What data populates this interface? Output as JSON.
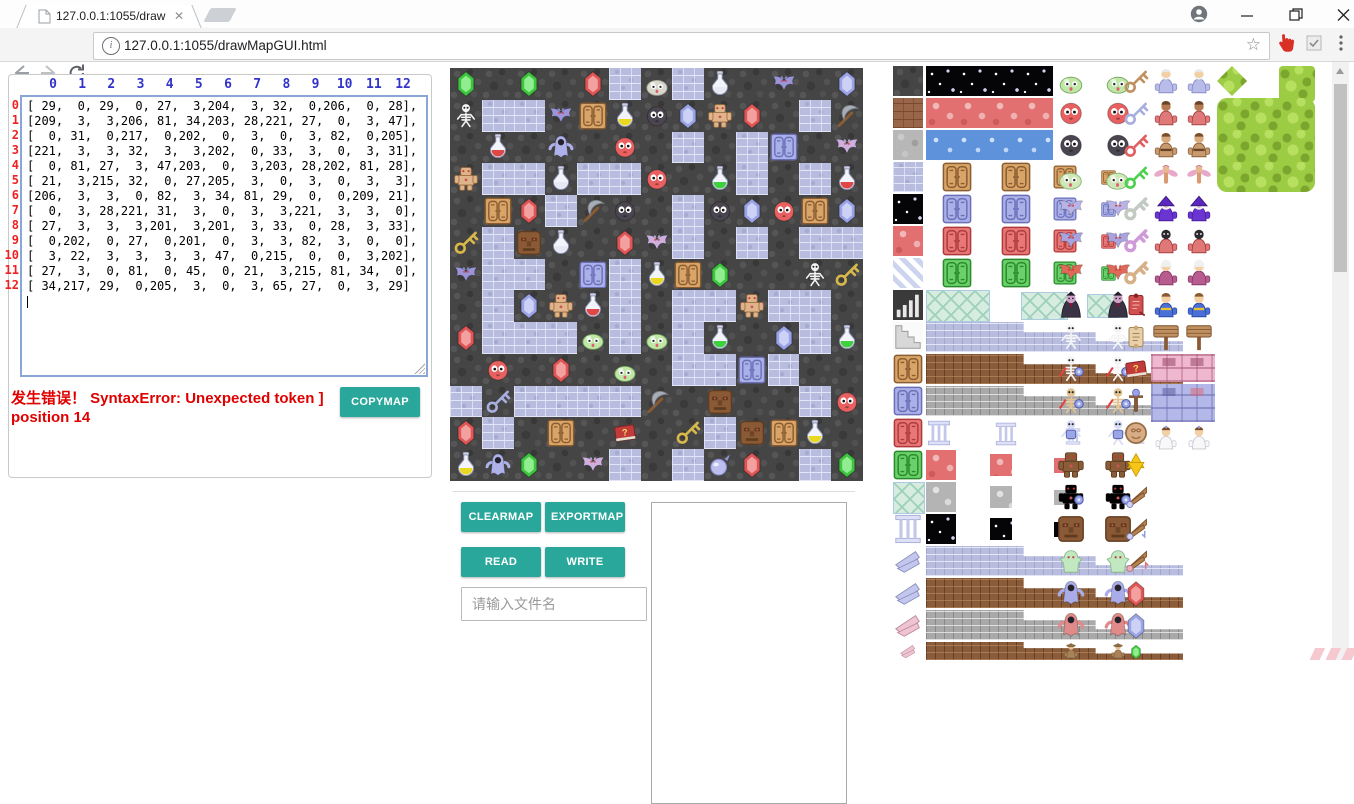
{
  "browser": {
    "tab_title": "127.0.0.1:1055/drawMa",
    "url": "127.0.0.1:1055/drawMapGUI.html",
    "info_glyph": "i"
  },
  "matrix": {
    "col_headers": [
      0,
      1,
      2,
      3,
      4,
      5,
      6,
      7,
      8,
      9,
      10,
      11,
      12
    ],
    "row_headers": [
      0,
      1,
      2,
      3,
      4,
      5,
      6,
      7,
      8,
      9,
      10,
      11,
      12
    ],
    "rows": [
      [
        29,
        0,
        29,
        0,
        27,
        3,
        204,
        3,
        32,
        0,
        206,
        0,
        28
      ],
      [
        209,
        3,
        3,
        206,
        81,
        34,
        203,
        28,
        221,
        27,
        0,
        3,
        47
      ],
      [
        0,
        31,
        0,
        217,
        0,
        202,
        0,
        3,
        0,
        3,
        82,
        0,
        205
      ],
      [
        221,
        3,
        3,
        32,
        3,
        3,
        202,
        0,
        33,
        3,
        0,
        3,
        31
      ],
      [
        0,
        81,
        27,
        3,
        47,
        203,
        0,
        3,
        203,
        28,
        202,
        81,
        28
      ],
      [
        21,
        3,
        215,
        32,
        0,
        27,
        205,
        3,
        0,
        3,
        0,
        3,
        3
      ],
      [
        206,
        3,
        3,
        0,
        82,
        3,
        34,
        81,
        29,
        0,
        0,
        209,
        21
      ],
      [
        0,
        3,
        28,
        221,
        31,
        3,
        0,
        3,
        3,
        221,
        3,
        3,
        0
      ],
      [
        27,
        3,
        3,
        3,
        201,
        3,
        201,
        3,
        33,
        0,
        28,
        3,
        33
      ],
      [
        0,
        202,
        0,
        27,
        0,
        201,
        0,
        3,
        3,
        82,
        3,
        0,
        0
      ],
      [
        3,
        22,
        3,
        3,
        3,
        3,
        47,
        0,
        215,
        0,
        0,
        3,
        202
      ],
      [
        27,
        3,
        0,
        81,
        0,
        45,
        0,
        21,
        3,
        215,
        81,
        34,
        0
      ],
      [
        34,
        217,
        29,
        0,
        205,
        3,
        0,
        3,
        65,
        27,
        0,
        3,
        29
      ]
    ]
  },
  "error": {
    "line1": "发生错误！ SyntaxError: Unexpected token ]",
    "line2": "position 14"
  },
  "buttons": {
    "copymap": "COPYMAP",
    "clearmap": "CLEARMAP",
    "exportmap": "EXPORTMAP",
    "read": "READ",
    "write": "WRITE"
  },
  "file_input": {
    "placeholder": "请输入文件名",
    "value": ""
  },
  "colors": {
    "accent_teal": "#2aa79b",
    "error_red": "#e00000",
    "col_header_blue": "#3333cc",
    "row_header_red": "#ee2222"
  },
  "tile_legend": {
    "0": "cobble_dark",
    "3": "brick_lav",
    "21": "key_yellow",
    "22": "key_blue",
    "27": "gem_red",
    "28": "gem_blue",
    "29": "gem_green",
    "31": "potion_red",
    "32": "potion_silver",
    "33": "potion_green",
    "34": "potion_yellow",
    "45": "book",
    "47": "pickaxe",
    "65": "orb",
    "81": "door_tan",
    "82": "door_lav",
    "201": "slime_green",
    "202": "ball_red",
    "203": "ball_dark",
    "204": "slime_gray",
    "205": "bat_pink",
    "206": "bat_purple",
    "209": "skeleton",
    "215": "tiki",
    "217": "ghost",
    "221": "golem"
  },
  "tileset": {
    "cells": [
      [
        0,
        0,
        30,
        30,
        "cobble_dark"
      ],
      [
        0,
        32,
        30,
        30,
        "brick_brown"
      ],
      [
        0,
        64,
        30,
        30,
        "cobble_gray"
      ],
      [
        0,
        96,
        30,
        30,
        "brick_lav"
      ],
      [
        0,
        128,
        30,
        30,
        "night"
      ],
      [
        0,
        160,
        30,
        30,
        "floor_red"
      ],
      [
        0,
        192,
        30,
        30,
        "stripes"
      ],
      [
        0,
        224,
        30,
        30,
        "stairs_dark"
      ],
      [
        0,
        256,
        30,
        30,
        "steps_gray"
      ],
      [
        0,
        288,
        30,
        30,
        "door_tan"
      ],
      [
        0,
        320,
        30,
        30,
        "door_lav"
      ],
      [
        0,
        352,
        30,
        30,
        "door_red"
      ],
      [
        0,
        384,
        30,
        30,
        "door_green"
      ],
      [
        0,
        416,
        30,
        30,
        "ice"
      ],
      [
        0,
        448,
        30,
        30,
        "pillar"
      ],
      [
        0,
        480,
        30,
        30,
        "wing_lav"
      ],
      [
        0,
        512,
        30,
        30,
        "wing_lav"
      ],
      [
        0,
        544,
        30,
        30,
        "wing_pink"
      ],
      [
        0,
        576,
        30,
        18,
        "wing_pink"
      ],
      [
        33,
        0,
        127,
        30,
        "night"
      ],
      [
        33,
        32,
        127,
        30,
        "floor_red"
      ],
      [
        33,
        64,
        127,
        30,
        "water"
      ],
      [
        33,
        96,
        62,
        30,
        "door_tan"
      ],
      [
        108,
        96,
        30,
        30,
        "door_tan"
      ],
      [
        160,
        99,
        24,
        24,
        "door_tan"
      ],
      [
        208,
        104,
        15,
        15,
        "door_tan"
      ],
      [
        33,
        128,
        62,
        30,
        "door_lav"
      ],
      [
        108,
        128,
        30,
        30,
        "door_lav"
      ],
      [
        160,
        131,
        24,
        24,
        "door_lav"
      ],
      [
        208,
        136,
        15,
        15,
        "door_lav"
      ],
      [
        33,
        160,
        62,
        30,
        "door_red"
      ],
      [
        108,
        160,
        30,
        30,
        "door_red"
      ],
      [
        160,
        163,
        24,
        24,
        "door_red"
      ],
      [
        208,
        168,
        15,
        15,
        "door_red"
      ],
      [
        33,
        192,
        62,
        30,
        "door_green"
      ],
      [
        108,
        192,
        30,
        30,
        "door_green"
      ],
      [
        160,
        195,
        24,
        24,
        "door_green"
      ],
      [
        208,
        200,
        15,
        15,
        "door_green"
      ],
      [
        33,
        224,
        62,
        30,
        "ice"
      ],
      [
        128,
        226,
        45,
        26,
        "ice"
      ],
      [
        194,
        228,
        30,
        22,
        "ice"
      ],
      [
        33,
        256,
        257,
        30,
        "ledge_lav"
      ],
      [
        33,
        288,
        257,
        30,
        "ledge_brown"
      ],
      [
        33,
        320,
        257,
        30,
        "ledge_gray"
      ],
      [
        33,
        352,
        26,
        30,
        "pillar"
      ],
      [
        95,
        356,
        36,
        24,
        "pillar"
      ],
      [
        157,
        362,
        46,
        17,
        "pillar"
      ],
      [
        219,
        368,
        56,
        10,
        "pillar"
      ],
      [
        33,
        384,
        30,
        30,
        "floor_red"
      ],
      [
        97,
        388,
        22,
        22,
        "floor_red"
      ],
      [
        161,
        392,
        15,
        15,
        "floor_red"
      ],
      [
        225,
        396,
        7,
        7,
        "floor_red"
      ],
      [
        33,
        416,
        30,
        30,
        "floor_gray2"
      ],
      [
        97,
        420,
        22,
        22,
        "floor_gray2"
      ],
      [
        161,
        424,
        15,
        15,
        "floor_gray2"
      ],
      [
        225,
        428,
        7,
        7,
        "floor_gray2"
      ],
      [
        33,
        448,
        30,
        30,
        "night"
      ],
      [
        97,
        452,
        22,
        22,
        "night"
      ],
      [
        161,
        456,
        15,
        15,
        "night"
      ],
      [
        225,
        460,
        7,
        7,
        "night"
      ],
      [
        33,
        480,
        257,
        30,
        "ledge_lav"
      ],
      [
        33,
        512,
        257,
        30,
        "ledge_brown"
      ],
      [
        33,
        544,
        257,
        30,
        "ledge_gray"
      ],
      [
        33,
        576,
        257,
        18,
        "ledge_brown"
      ],
      [
        163,
        0,
        30,
        30,
        "slime_green"
      ],
      [
        210,
        0,
        30,
        30,
        "slime_green"
      ],
      [
        163,
        32,
        30,
        30,
        "ball_red"
      ],
      [
        210,
        32,
        30,
        30,
        "ball_red"
      ],
      [
        163,
        64,
        30,
        30,
        "ball_dark"
      ],
      [
        210,
        64,
        30,
        30,
        "ball_dark"
      ],
      [
        161,
        96,
        33,
        30,
        "slime_big"
      ],
      [
        208,
        96,
        33,
        30,
        "slime_big"
      ],
      [
        163,
        128,
        30,
        30,
        "bat_sm"
      ],
      [
        210,
        128,
        30,
        30,
        "bat_sm"
      ],
      [
        163,
        160,
        30,
        30,
        "bat_big"
      ],
      [
        210,
        160,
        30,
        30,
        "bat_big"
      ],
      [
        163,
        192,
        30,
        30,
        "bat_red"
      ],
      [
        210,
        192,
        30,
        30,
        "bat_red"
      ],
      [
        163,
        224,
        30,
        30,
        "vampire"
      ],
      [
        210,
        224,
        30,
        30,
        "vampire"
      ],
      [
        163,
        256,
        30,
        30,
        "skeleton"
      ],
      [
        210,
        256,
        30,
        30,
        "skeleton"
      ],
      [
        163,
        288,
        30,
        30,
        "skel_arm"
      ],
      [
        210,
        288,
        30,
        30,
        "skel_arm"
      ],
      [
        163,
        320,
        30,
        30,
        "skel_tan"
      ],
      [
        210,
        320,
        30,
        30,
        "skel_tan"
      ],
      [
        163,
        352,
        30,
        30,
        "skel_blue"
      ],
      [
        210,
        352,
        30,
        30,
        "skel_blue"
      ],
      [
        163,
        384,
        30,
        30,
        "ape"
      ],
      [
        210,
        384,
        30,
        30,
        "ape"
      ],
      [
        163,
        416,
        30,
        30,
        "ape_shield"
      ],
      [
        210,
        416,
        30,
        30,
        "ape_shield"
      ],
      [
        163,
        448,
        30,
        30,
        "tiki"
      ],
      [
        210,
        448,
        30,
        30,
        "tiki"
      ],
      [
        163,
        480,
        30,
        30,
        "slimeman"
      ],
      [
        210,
        480,
        30,
        30,
        "slimeman"
      ],
      [
        163,
        512,
        30,
        30,
        "ghost_blue"
      ],
      [
        210,
        512,
        30,
        30,
        "ghost_blue"
      ],
      [
        163,
        544,
        30,
        30,
        "ghost_red"
      ],
      [
        210,
        544,
        30,
        30,
        "ghost_red"
      ],
      [
        163,
        576,
        30,
        18,
        "hatman"
      ],
      [
        210,
        576,
        30,
        18,
        "hatman"
      ],
      [
        229,
        2,
        28,
        28,
        "key_tan"
      ],
      [
        229,
        34,
        28,
        28,
        "key_blue"
      ],
      [
        229,
        66,
        28,
        28,
        "key_red"
      ],
      [
        229,
        98,
        28,
        28,
        "key_green"
      ],
      [
        229,
        128,
        28,
        30,
        "key_big_gray"
      ],
      [
        229,
        160,
        28,
        30,
        "key_big_purple"
      ],
      [
        229,
        192,
        28,
        30,
        "key_big_tan"
      ],
      [
        229,
        224,
        28,
        30,
        "scroll_red"
      ],
      [
        229,
        256,
        28,
        30,
        "scroll_tan"
      ],
      [
        229,
        288,
        28,
        30,
        "book"
      ],
      [
        229,
        320,
        28,
        30,
        "staff"
      ],
      [
        229,
        352,
        28,
        30,
        "coin"
      ],
      [
        229,
        384,
        28,
        30,
        "star"
      ],
      [
        229,
        416,
        28,
        30,
        "wing1"
      ],
      [
        229,
        448,
        28,
        30,
        "wing2"
      ],
      [
        229,
        480,
        28,
        30,
        "wing3"
      ],
      [
        229,
        514,
        28,
        28,
        "gem_red"
      ],
      [
        229,
        546,
        28,
        28,
        "gem_blue"
      ],
      [
        229,
        578,
        28,
        16,
        "gem_green"
      ],
      [
        258,
        0,
        30,
        30,
        "oldman"
      ],
      [
        291,
        0,
        30,
        30,
        "oldman"
      ],
      [
        258,
        32,
        30,
        30,
        "elder"
      ],
      [
        291,
        32,
        30,
        30,
        "elder"
      ],
      [
        258,
        64,
        30,
        30,
        "fighter"
      ],
      [
        291,
        64,
        30,
        30,
        "fighter"
      ],
      [
        258,
        96,
        30,
        30,
        "fairy"
      ],
      [
        291,
        96,
        30,
        30,
        "fairy"
      ],
      [
        258,
        128,
        30,
        30,
        "wizard"
      ],
      [
        291,
        128,
        30,
        30,
        "wizard"
      ],
      [
        258,
        160,
        30,
        30,
        "priest_dark"
      ],
      [
        291,
        160,
        30,
        30,
        "priest_dark"
      ],
      [
        258,
        192,
        30,
        30,
        "priest_white"
      ],
      [
        291,
        192,
        30,
        30,
        "priest_white"
      ],
      [
        258,
        224,
        30,
        30,
        "hero"
      ],
      [
        291,
        224,
        30,
        30,
        "hero"
      ],
      [
        258,
        256,
        30,
        30,
        "sign"
      ],
      [
        291,
        256,
        30,
        30,
        "sign"
      ],
      [
        258,
        288,
        64,
        28,
        "wall_pink"
      ],
      [
        258,
        318,
        64,
        38,
        "wall_lav"
      ],
      [
        258,
        358,
        30,
        28,
        "princess"
      ],
      [
        291,
        358,
        30,
        28,
        "princess"
      ],
      [
        324,
        0,
        30,
        30,
        "tree_diamond"
      ],
      [
        386,
        0,
        36,
        36,
        "tree_sq"
      ],
      [
        324,
        32,
        98,
        94,
        "forest"
      ]
    ]
  }
}
